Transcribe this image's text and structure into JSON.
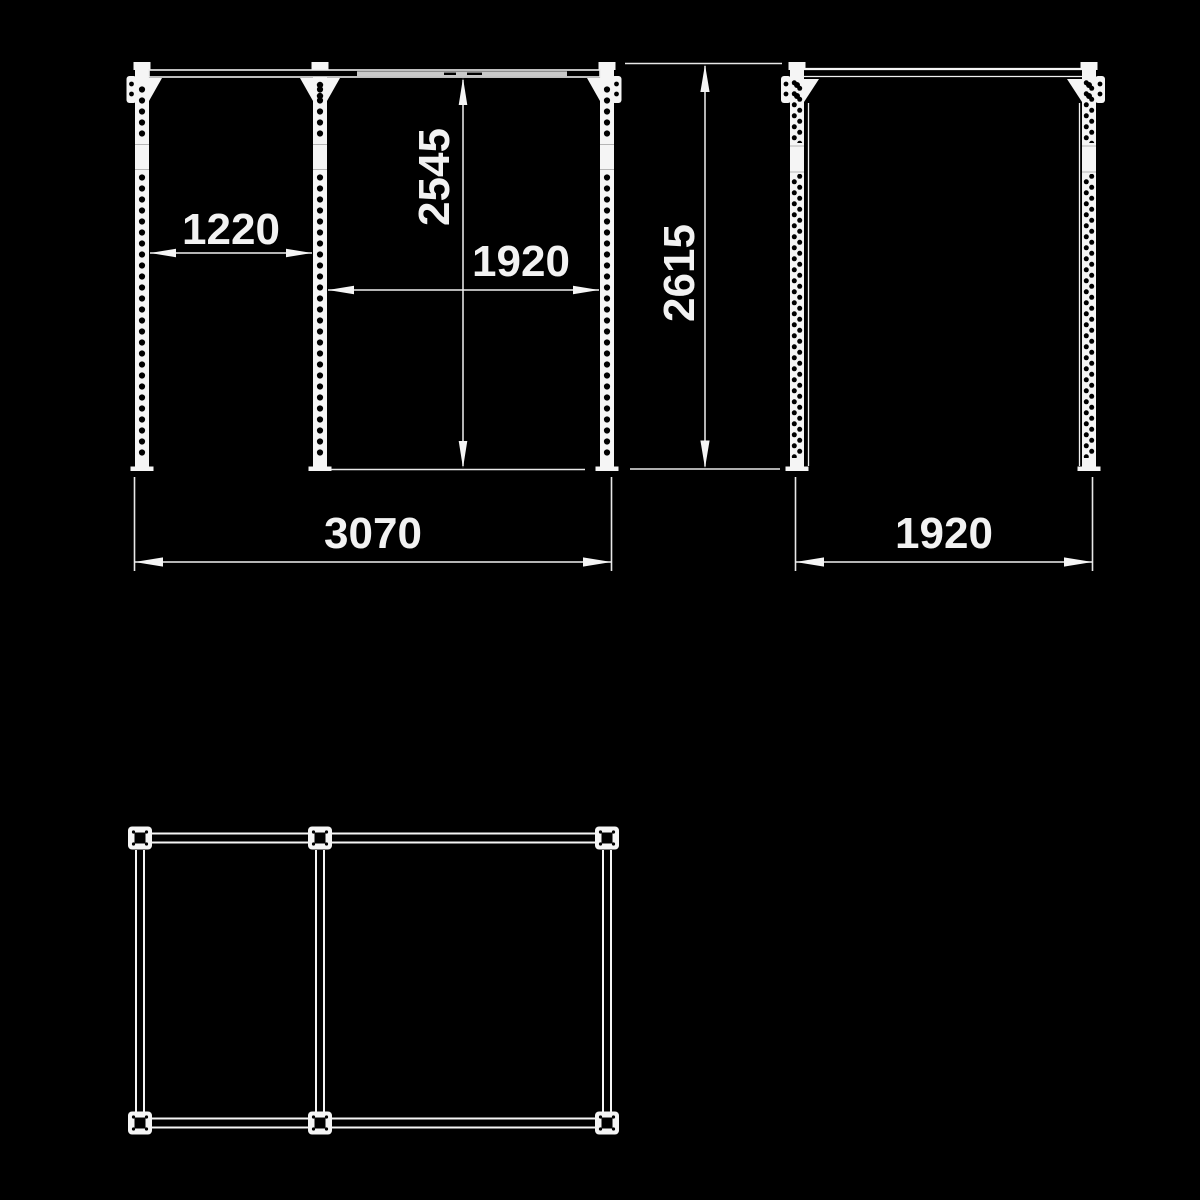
{
  "drawing": {
    "kind": "technical dimension drawing",
    "views": [
      "front elevation",
      "side elevation",
      "plan view"
    ]
  },
  "colors": {
    "background": "#000000",
    "line": "#f5f5f5",
    "text": "#f2f2f2",
    "bar_fill": "#c9c9c9"
  },
  "views": {
    "front_elevation": {
      "dimensions": {
        "left_bay_width": "1220",
        "height_to_bar": "2545",
        "right_bay_width": "1920",
        "overall_width": "3070"
      }
    },
    "side_elevation": {
      "dimensions": {
        "overall_height": "2615",
        "depth": "1920"
      }
    },
    "plan_view": {
      "dimensions": {}
    }
  }
}
